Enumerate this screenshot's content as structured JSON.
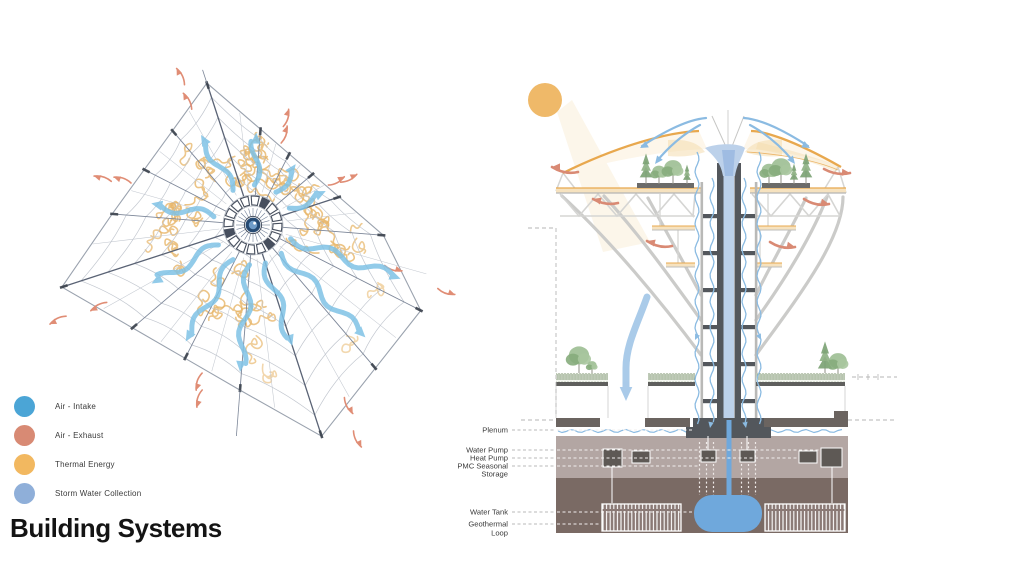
{
  "title": "Building Systems",
  "legend": {
    "items": [
      {
        "label": "Air - Intake",
        "color": "#4BA5D6"
      },
      {
        "label": "Air - Exhaust",
        "color": "#D88A74"
      },
      {
        "label": "Thermal Energy",
        "color": "#F2B860"
      },
      {
        "label": "Storm Water Collection",
        "color": "#8FAFD9"
      }
    ]
  },
  "plan": {
    "description": "radial web plan diagram with air intake arrows, exhaust arrows and thermal energy meanders",
    "colors": {
      "spoke": "#7C8698",
      "spoke_dark": "#5A6375",
      "spoke_light": "#C3C8D0",
      "ring": "#C2C7CF",
      "rim": "#9AA2AE",
      "tick": "#3E4550",
      "thermal": "#E7B568",
      "intake": "#7FC2E6",
      "exhaust": "#E08D75",
      "hub_dark": "#474F5E",
      "hub_center": "#264A73",
      "hub_inner": "#6F9CC9"
    }
  },
  "section": {
    "description": "tower section with canopy, storm water funnel, planted decks and underground systems",
    "labels": [
      {
        "text": "Plenum",
        "y": 430,
        "tx": 692
      },
      {
        "text": "Water Pump",
        "y": 450,
        "tx": 820
      },
      {
        "text": "Heat Pump",
        "y": 458,
        "tx": 798
      },
      {
        "text": "PMC Seasonal",
        "y": 466,
        "tx": 698
      },
      {
        "text": "Storage",
        "y": 474,
        "tx": 0
      },
      {
        "text": "Water Tank",
        "y": 512,
        "tx": 692
      },
      {
        "text": "Geothermal",
        "y": 524,
        "tx": 601
      },
      {
        "text": "Loop",
        "y": 533,
        "tx": 0
      }
    ],
    "colors": {
      "sun": "#EFB969",
      "beam": "#F6DFB4",
      "canopy": "#E8A84E",
      "canopy_fill": "#FDF6EA",
      "canopy_shade": "#F3D9A8",
      "deck_fill": "#F6E2BF",
      "structure": "#CBCBC9",
      "truss": "#D5D5D3",
      "shaft_dark": "#53575C",
      "shaft_outer": "#B9B9B7",
      "water_light": "#BCD1EA",
      "water_core": "#9FBCE2",
      "water_mid": "#6FA8DC",
      "arrow_blue": "#8BBBE2",
      "intake_big": "#A5C8E8",
      "exhaust": "#D98A74",
      "soil_light": "#B3A6A3",
      "soil_dark": "#7A6A64",
      "slab": "#6B6460",
      "curb": "#5F5F5D",
      "pump": "#5E5955",
      "geo_fill": "#8A7975",
      "grass": "#7E9573",
      "grass2": "#94A98B",
      "grass_bg": "#F4F6F0",
      "leader": "#B8B8B8",
      "leader_white": "#F2EFEE",
      "label_text": "#3b3b3b",
      "guide": "#B5B5B5"
    }
  }
}
